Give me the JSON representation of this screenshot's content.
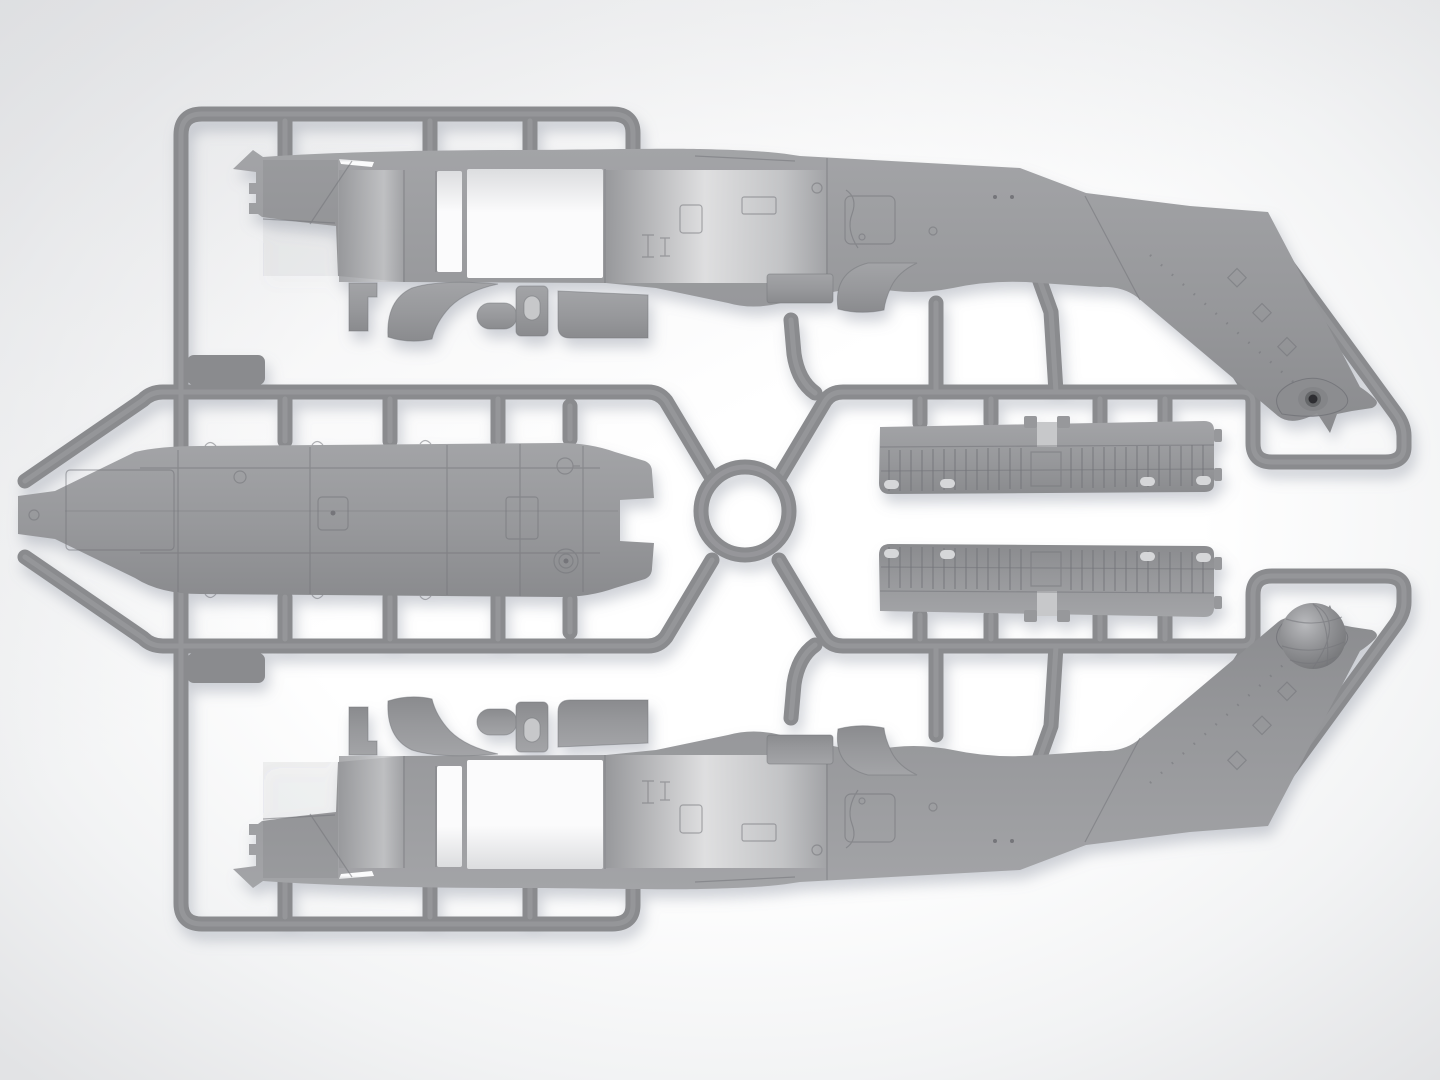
{
  "scene": {
    "kind": "3d-render-of-model-kit-sprue",
    "description": "Light gray injection-molded styrene sprue of a helicopter model kit, photographed/rendered top-down on a white studio background with soft drop shadows",
    "orientation": "two mirrored fuselage halves (noses pointing left, tail booms angled toward the right corners), long cabin floor part at center-left, two ribbed cabin panels at center-right, circular runner ring in the middle"
  },
  "palette": {
    "background_center": "#ffffff",
    "background_mid": "#f2f3f4",
    "background_edge": "#e2e3e5",
    "corner_shade": "#d9dadd",
    "plastic": "#97989b",
    "plastic_top": "#a3a4a7",
    "plastic_bottom": "#8a8b8e",
    "plastic_dark": "#848588",
    "runner": "#8a8b8e",
    "runner_highlight": "#a4a5a8",
    "panel_line": "#74757a",
    "opening_top": "#dcdddf",
    "opening_bottom": "#fbfbfc",
    "lit_core": "#e6e6e7",
    "recess": "#c7c8ca",
    "hole": "#d6d7d9",
    "hub_ring": "#66676b",
    "hub_center": "#2e2f31",
    "ball_light": "#b9babd",
    "ball_mid": "#8f9093",
    "ball_dark": "#737477",
    "shadow": "#8b92a0"
  },
  "sprue": {
    "runner_ring": "circular runner at sprue center",
    "rails": [
      "top rail",
      "left rail",
      "bottom rail",
      "upper middle rail",
      "lower middle rail",
      "right loop around upper tail boom",
      "right loop around lower tail boom"
    ],
    "gate_stubs_visible": 24,
    "parts": [
      {
        "id": "fuselage-half-upper",
        "name": "helicopter fuselage half (upper)",
        "features": [
          "pointed nose at left",
          "cabin door opening",
          "narrow window opening",
          "tail boom angled down-right",
          "tail rotor hub with dark center"
        ]
      },
      {
        "id": "fuselage-half-lower",
        "name": "helicopter fuselage half (lower, mirrored)",
        "features": [
          "pointed nose at left",
          "cabin door opening",
          "tail boom angled up-right",
          "sensor dome ball over tail hub"
        ]
      },
      {
        "id": "cabin-floor",
        "name": "cabin floor panel",
        "features": [
          "flat pointed left tip",
          "hatches",
          "filler caps",
          "notched right end"
        ]
      },
      {
        "id": "roof-panel-upper",
        "name": "ribbed cabin panel (upper)",
        "features": [
          "corrugated ribs",
          "four oval holes",
          "center joint tabs"
        ]
      },
      {
        "id": "roof-panel-lower",
        "name": "ribbed cabin panel (lower, mirrored)",
        "features": [
          "corrugated ribs",
          "four oval holes",
          "center joint tabs"
        ]
      },
      {
        "id": "sensor-ball",
        "name": "spherical sensor dome",
        "features": [
          "meridian grid on right half"
        ]
      },
      {
        "id": "small-parts-row",
        "name": "row of small parts (x2, mirrored)",
        "features": [
          "L-bracket",
          "curved cockpit coaming",
          "oval pad",
          "door panel with window",
          "equipment shelf",
          "vented box",
          "intake scoop"
        ]
      }
    ]
  }
}
